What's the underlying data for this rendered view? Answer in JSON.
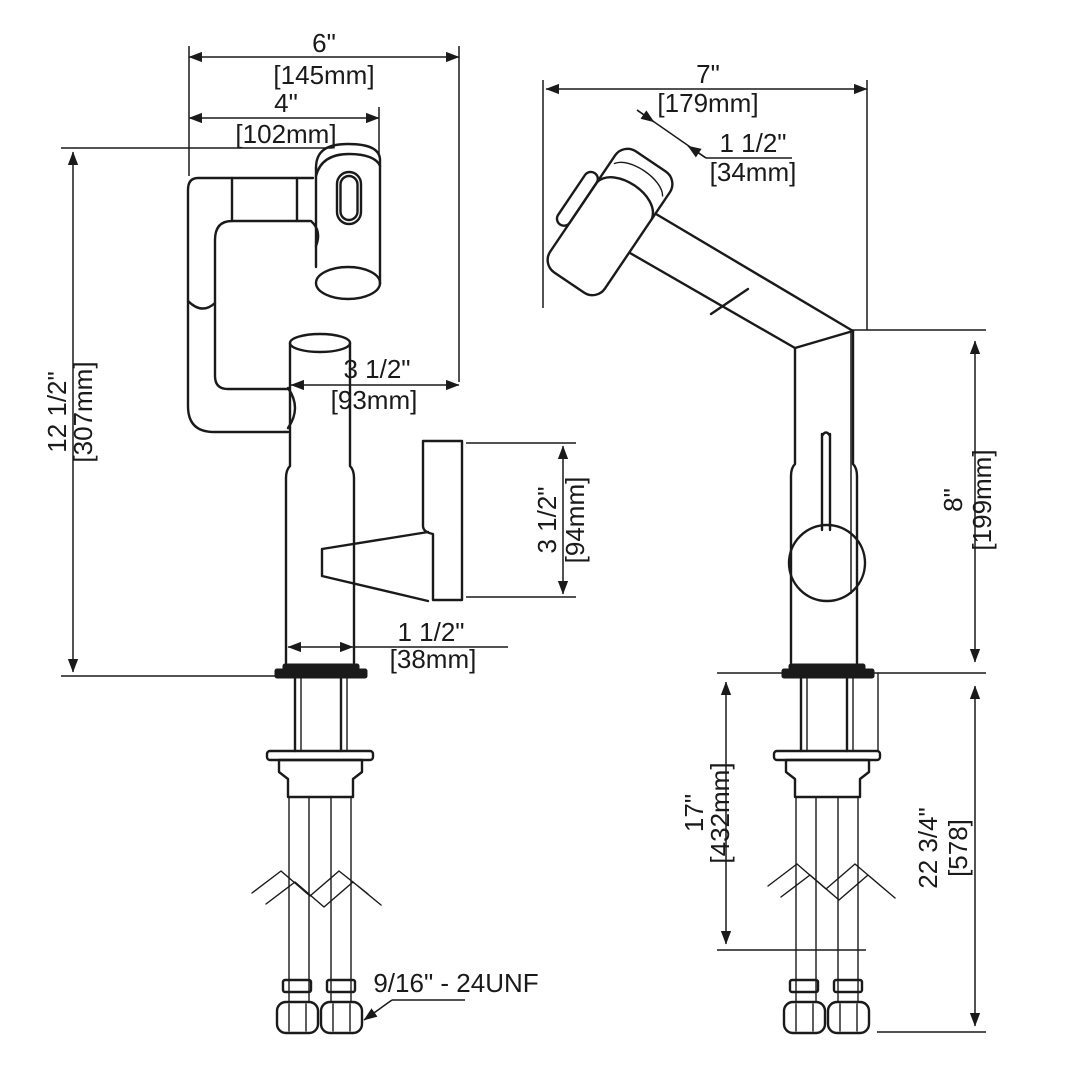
{
  "drawing_type": "faucet-dimension-diagram",
  "colors": {
    "line": "#1a1a1a",
    "background": "#ffffff"
  },
  "front": {
    "overall_width": {
      "in": "6\"",
      "mm": "[145mm]"
    },
    "spout_width": {
      "in": "4\"",
      "mm": "[102mm]"
    },
    "overall_height": {
      "in": "12 1/2\"",
      "mm": "[307mm]"
    },
    "spout_reach": {
      "in": "3 1/2\"",
      "mm": "[93mm]"
    },
    "handle_section_height": {
      "in": "3 1/2\"",
      "mm": "[94mm]"
    },
    "base_diameter": {
      "in": "1 1/2\"",
      "mm": "[38mm]"
    },
    "supply_thread": "9/16\" - 24UNF"
  },
  "side": {
    "overall_depth": {
      "in": "7\"",
      "mm": "[179mm]"
    },
    "spray_head_width": {
      "in": "1 1/2\"",
      "mm": "[34mm]"
    },
    "height_above_counter": {
      "in": "8\"",
      "mm": "[199mm]"
    },
    "supply_hose_length": {
      "in": "17\"",
      "mm": "[432mm]"
    },
    "overall_height": {
      "in": "22 3/4\"",
      "mm": "[578]"
    }
  }
}
